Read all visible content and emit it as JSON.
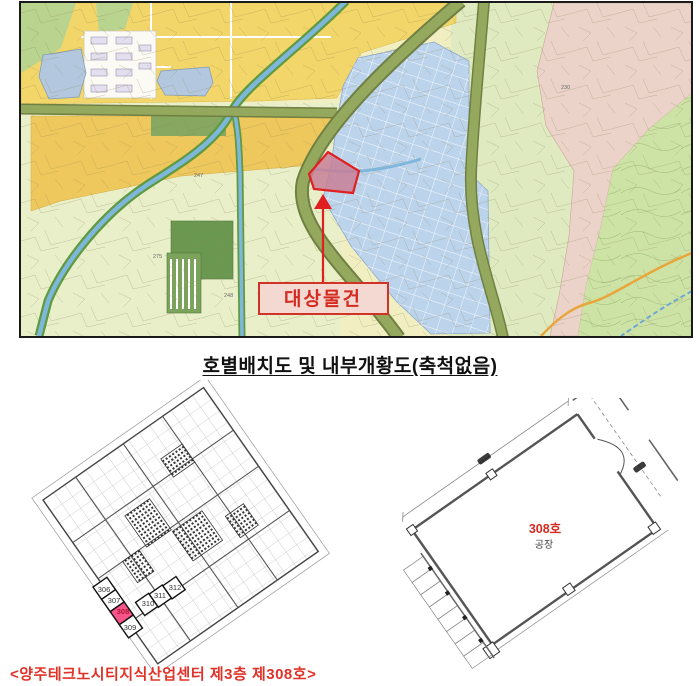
{
  "map": {
    "target_label": "대상물건",
    "parcel_labels": [
      "230",
      "247",
      "275",
      "248"
    ],
    "colors": {
      "target_border": "#e02020",
      "target_fill": "#c87f96",
      "label_box_fill": "#f4d9d2",
      "industrial_zone": "#bcd3ec",
      "road_olive": "#95a95e",
      "river_blue": "#7eb6dc",
      "mountain_pink": "#ebd3c9",
      "residential_yellow": "#f3d669"
    }
  },
  "section_title": "호별배치도 및 내부개황도(축척없음)",
  "left_plan": {
    "units": [
      "306",
      "307",
      "308",
      "309",
      "310",
      "311",
      "312"
    ],
    "highlighted_unit": "308"
  },
  "right_plan": {
    "unit_label": "308호",
    "use_label": "공장"
  },
  "caption": "<양주테크노시티지식산업센터 제3층 제308호>"
}
